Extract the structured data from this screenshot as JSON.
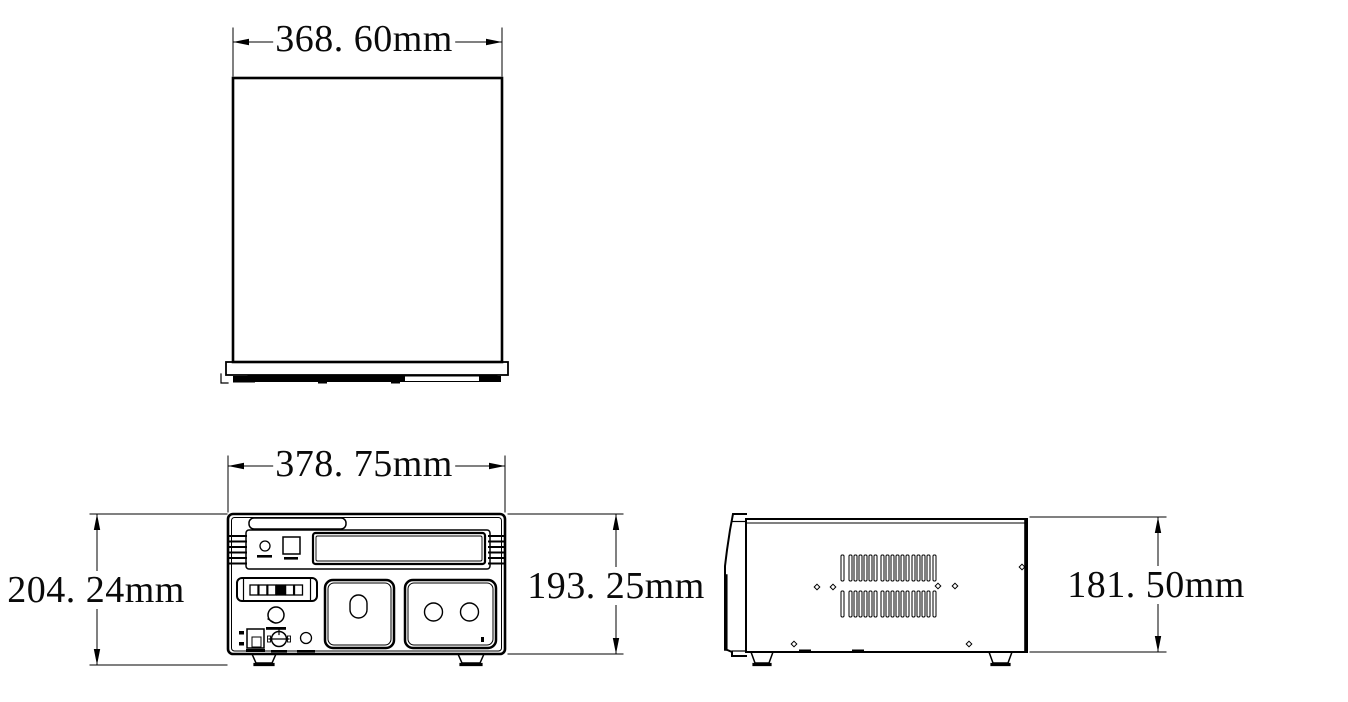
{
  "page": {
    "background_color": "#ffffff",
    "line_color": "#000000"
  },
  "drawing": {
    "type": "technical-dimension-drawing",
    "views": [
      "top-view",
      "front-view",
      "side-view"
    ],
    "dimensions": {
      "top_width": "368. 60mm",
      "front_width": "378. 75mm",
      "front_total_height": "204. 24mm",
      "front_body_height": "193. 25mm",
      "side_height": "181. 50mm"
    }
  }
}
